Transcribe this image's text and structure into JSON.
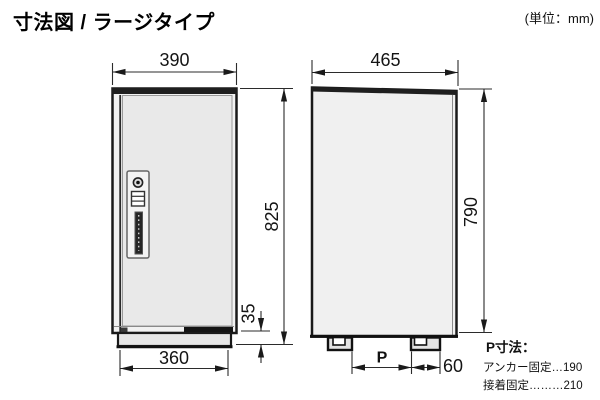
{
  "page": {
    "title": "寸法図 / ラージタイプ",
    "unit_label": "(単位：mm)"
  },
  "front_view": {
    "dimensions": {
      "top_width": "390",
      "total_height": "825",
      "base_height": "35",
      "bottom_width": "360"
    }
  },
  "side_view": {
    "dimensions": {
      "top_depth": "465",
      "body_height": "790",
      "foot_pitch": "P",
      "foot_offset": "60"
    }
  },
  "p_note": {
    "heading": "P寸法：",
    "anchor_line": "アンカー固定…190",
    "adhesive_line": "接着固定………210"
  },
  "colors": {
    "ink": "#1a1a1a",
    "panel_fill": "#f0f0f0"
  }
}
